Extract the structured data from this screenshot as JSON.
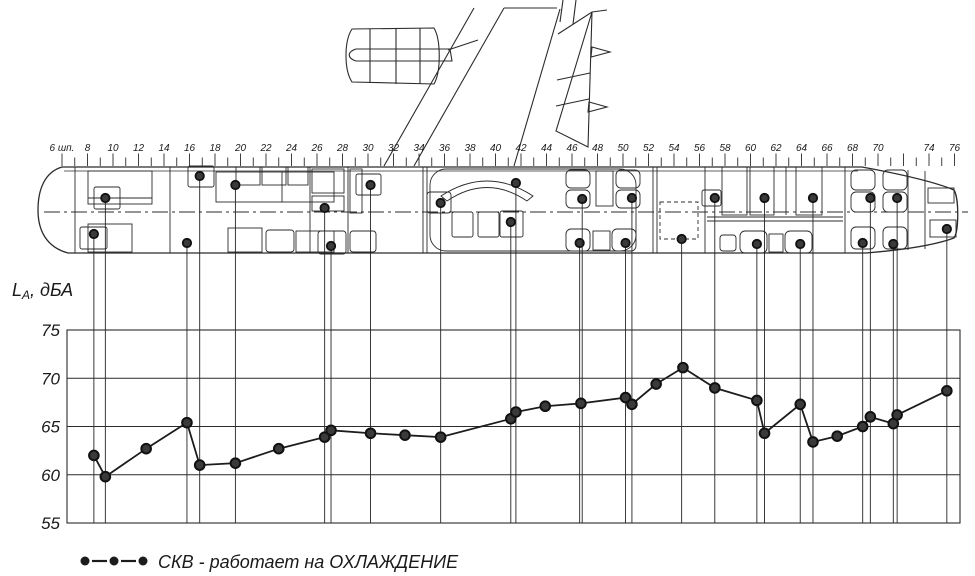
{
  "figure": {
    "ylabel": {
      "sym": "L",
      "sub": "А",
      "rest": ", дБА"
    },
    "ruler": {
      "unit_label": "6 шп.",
      "labels": [
        {
          "f": 6,
          "label": "6 шп."
        },
        {
          "f": 8,
          "label": "8"
        },
        {
          "f": 10,
          "label": "10"
        },
        {
          "f": 12,
          "label": "12"
        },
        {
          "f": 14,
          "label": "14"
        },
        {
          "f": 16,
          "label": "16"
        },
        {
          "f": 18,
          "label": "18"
        },
        {
          "f": 20,
          "label": "20"
        },
        {
          "f": 22,
          "label": "22"
        },
        {
          "f": 24,
          "label": "24"
        },
        {
          "f": 26,
          "label": "26"
        },
        {
          "f": 28,
          "label": "28"
        },
        {
          "f": 30,
          "label": "30"
        },
        {
          "f": 32,
          "label": "32"
        },
        {
          "f": 34,
          "label": "34"
        },
        {
          "f": 36,
          "label": "36"
        },
        {
          "f": 38,
          "label": "38"
        },
        {
          "f": 40,
          "label": "40"
        },
        {
          "f": 42,
          "label": "42"
        },
        {
          "f": 44,
          "label": "44"
        },
        {
          "f": 46,
          "label": "46"
        },
        {
          "f": 48,
          "label": "48"
        },
        {
          "f": 50,
          "label": "50"
        },
        {
          "f": 52,
          "label": "52"
        },
        {
          "f": 54,
          "label": "54"
        },
        {
          "f": 56,
          "label": "56"
        },
        {
          "f": 58,
          "label": "58"
        },
        {
          "f": 60,
          "label": "60"
        },
        {
          "f": 62,
          "label": "62"
        },
        {
          "f": 64,
          "label": "64"
        },
        {
          "f": 66,
          "label": "66"
        },
        {
          "f": 68,
          "label": "68"
        },
        {
          "f": 70,
          "label": "70"
        },
        {
          "f": 74,
          "label": "74"
        },
        {
          "f": 76,
          "label": "76"
        }
      ],
      "frame_min": 6,
      "frame_max": 76
    },
    "plan": {
      "measurement_connectors": [
        {
          "frame": 8.5,
          "plan_y": 234
        },
        {
          "frame": 9.4,
          "plan_y": 198
        },
        {
          "frame": 15.8,
          "plan_y": 243
        },
        {
          "frame": 16.8,
          "plan_y": 176
        },
        {
          "frame": 19.6,
          "plan_y": 185
        },
        {
          "frame": 26.6,
          "plan_y": 208
        },
        {
          "frame": 27.1,
          "plan_y": 246
        },
        {
          "frame": 30.2,
          "plan_y": 185
        },
        {
          "frame": 35.7,
          "plan_y": 203
        },
        {
          "frame": 41.2,
          "plan_y": 222
        },
        {
          "frame": 41.6,
          "plan_y": 183
        },
        {
          "frame": 46.6,
          "plan_y": 243
        },
        {
          "frame": 46.8,
          "plan_y": 199
        },
        {
          "frame": 50.2,
          "plan_y": 243
        },
        {
          "frame": 50.7,
          "plan_y": 198
        },
        {
          "frame": 54.6,
          "plan_y": 239
        },
        {
          "frame": 57.2,
          "plan_y": 198
        },
        {
          "frame": 60.5,
          "plan_y": 244
        },
        {
          "frame": 61.1,
          "plan_y": 198
        },
        {
          "frame": 63.9,
          "plan_y": 244
        },
        {
          "frame": 64.9,
          "plan_y": 198
        },
        {
          "frame": 68.8,
          "plan_y": 243
        },
        {
          "frame": 69.4,
          "plan_y": 198
        },
        {
          "frame": 71.2,
          "plan_y": 244
        },
        {
          "frame": 71.5,
          "plan_y": 198
        },
        {
          "frame": 75.4,
          "plan_y": 229
        }
      ]
    }
  },
  "chart_data": {
    "type": "line",
    "title": "",
    "xlabel": "",
    "x_unit": "шп.",
    "ylabel": "Lа, дБА",
    "ylim": [
      55,
      75
    ],
    "yticks": [
      55,
      60,
      65,
      70,
      75
    ],
    "x_range_frames": [
      6,
      76
    ],
    "x_tick_step": 1,
    "x_label_step": 2,
    "grid": "horizontal",
    "legend_position": "bottom-left",
    "series": [
      {
        "name": "СКВ - работает на ОХЛАЖДЕНИЕ",
        "points": [
          {
            "frame": 8.5,
            "db": 62.0
          },
          {
            "frame": 9.4,
            "db": 59.8
          },
          {
            "frame": 12.6,
            "db": 62.7
          },
          {
            "frame": 15.8,
            "db": 65.4
          },
          {
            "frame": 16.8,
            "db": 61.0
          },
          {
            "frame": 19.6,
            "db": 61.2
          },
          {
            "frame": 23.0,
            "db": 62.7
          },
          {
            "frame": 26.6,
            "db": 63.9
          },
          {
            "frame": 27.1,
            "db": 64.6
          },
          {
            "frame": 30.2,
            "db": 64.3
          },
          {
            "frame": 32.9,
            "db": 64.1
          },
          {
            "frame": 35.7,
            "db": 63.9
          },
          {
            "frame": 41.2,
            "db": 65.8
          },
          {
            "frame": 41.6,
            "db": 66.5
          },
          {
            "frame": 43.9,
            "db": 67.1
          },
          {
            "frame": 46.7,
            "db": 67.4
          },
          {
            "frame": 50.2,
            "db": 68.0
          },
          {
            "frame": 50.7,
            "db": 67.3
          },
          {
            "frame": 52.6,
            "db": 69.4
          },
          {
            "frame": 54.7,
            "db": 71.1
          },
          {
            "frame": 57.2,
            "db": 69.0
          },
          {
            "frame": 60.5,
            "db": 67.7
          },
          {
            "frame": 61.1,
            "db": 64.3
          },
          {
            "frame": 63.9,
            "db": 67.3
          },
          {
            "frame": 64.9,
            "db": 63.4
          },
          {
            "frame": 66.8,
            "db": 64.0
          },
          {
            "frame": 68.8,
            "db": 65.0
          },
          {
            "frame": 69.4,
            "db": 66.0
          },
          {
            "frame": 71.2,
            "db": 65.3
          },
          {
            "frame": 71.5,
            "db": 66.2
          },
          {
            "frame": 75.4,
            "db": 68.7
          }
        ]
      }
    ]
  }
}
